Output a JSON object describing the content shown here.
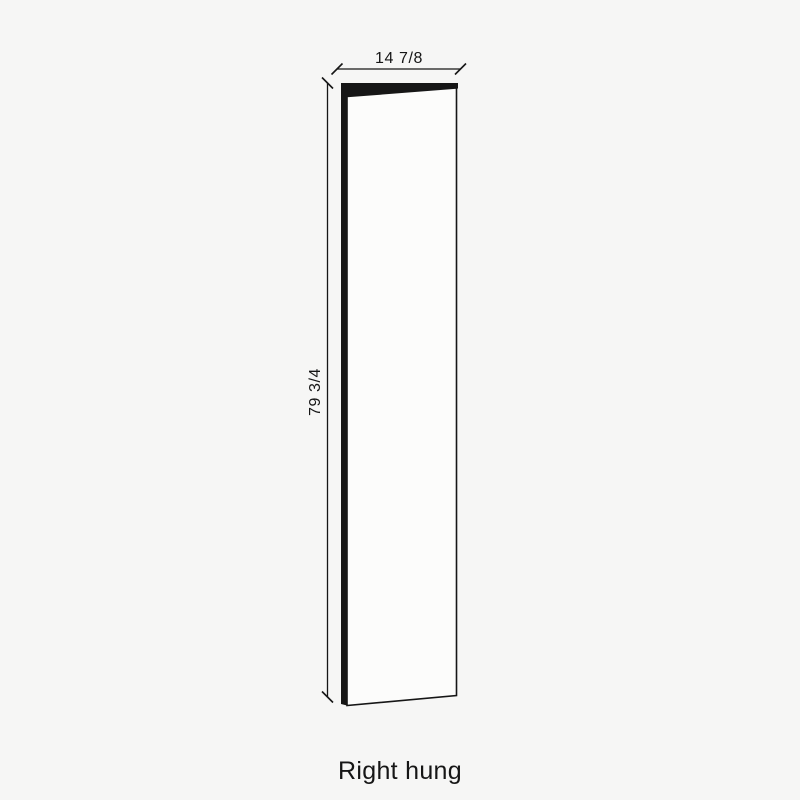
{
  "diagram": {
    "type": "door-panel-dimension-drawing",
    "caption": "Right hung",
    "width_label": "14 7/8",
    "height_label": "79 3/4",
    "colors": {
      "background": "#f6f6f5",
      "line": "#161616",
      "face": "#fcfcfb",
      "text": "#161616"
    }
  }
}
